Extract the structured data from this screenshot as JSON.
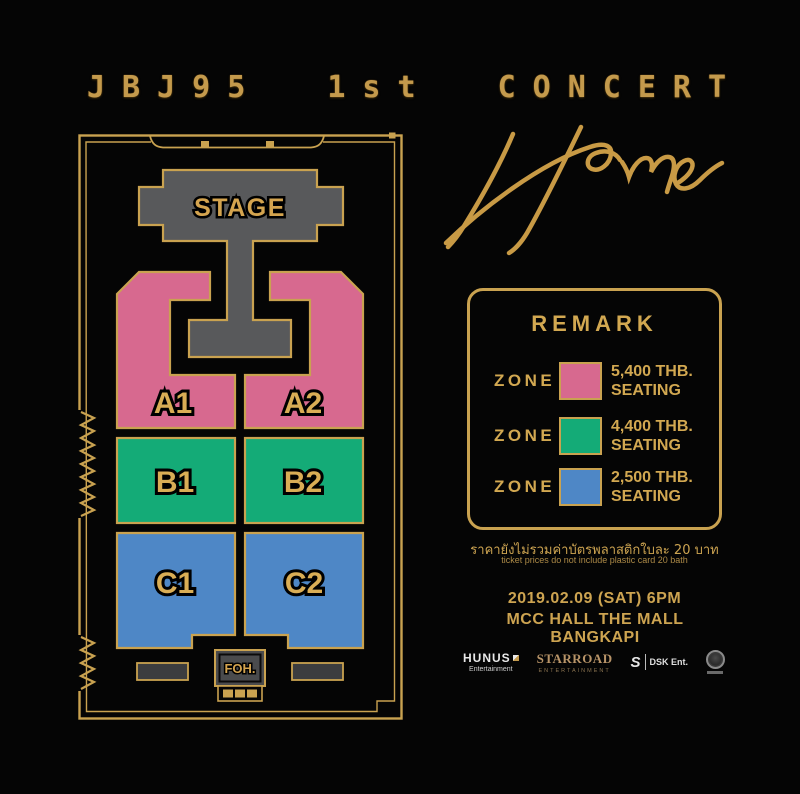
{
  "title": {
    "text": "JBJ95 1st CONCERT"
  },
  "logo": {
    "text": "Home"
  },
  "map": {
    "stage_label": "STAGE",
    "foh_label": "FOH.",
    "zone_labels": {
      "a1": "A1",
      "a2": "A2",
      "b1": "B1",
      "b2": "B2",
      "c1": "C1",
      "c2": "C2"
    }
  },
  "remark": {
    "title": "REMARK",
    "rows": [
      {
        "zone_label": "ZONE",
        "price": "5,400 THB.",
        "seating": "SEATING",
        "color": "#d7698f"
      },
      {
        "zone_label": "ZONE",
        "price": "4,400 THB.",
        "seating": "SEATING",
        "color": "#14ab77"
      },
      {
        "zone_label": "ZONE",
        "price": "2,500 THB.",
        "seating": "SEATING",
        "color": "#4e87c6"
      }
    ],
    "note_thai": "ราคายังไม่รวมค่าบัตรพลาสติกใบละ 20 บาท",
    "note_english": "ticket prices do not include plastic card 20 bath"
  },
  "event": {
    "datetime": "2019.02.09 (SAT) 6PM",
    "venue": "MCC HALL THE MALL BANGKAPI"
  },
  "sponsors": [
    {
      "name": "HUNUS",
      "subtitle": "Entertainment"
    },
    {
      "name": "STARROAD",
      "subtitle": "ENTERTAINMENT"
    },
    {
      "name": "DSK Ent.",
      "glyph": "S"
    }
  ],
  "colors": {
    "background": "#050505",
    "gold_line": "#c9a250",
    "gold_text": "#d2a851",
    "zone_pink": "#d7698f",
    "zone_green": "#14ab77",
    "zone_blue": "#4e87c6",
    "stage_gray": "#58595b"
  }
}
